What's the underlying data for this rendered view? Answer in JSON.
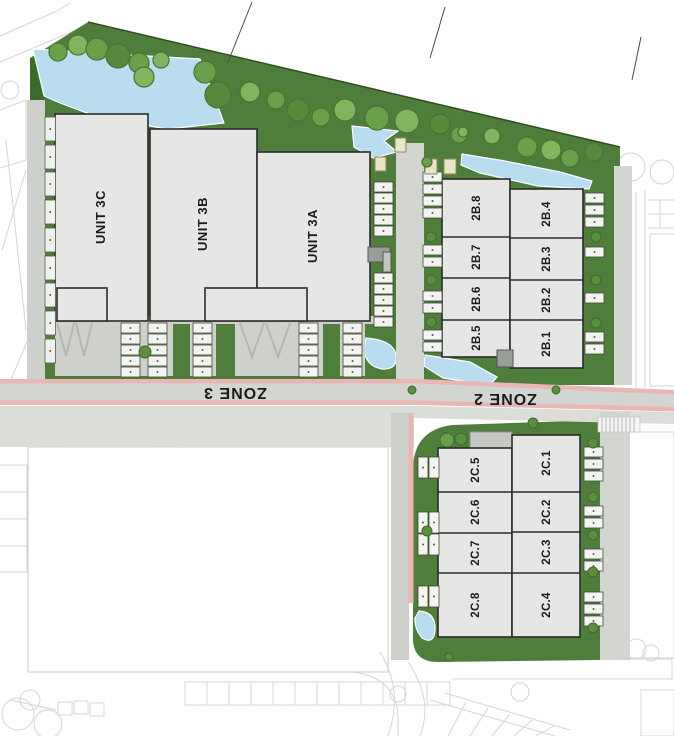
{
  "plan": {
    "zone_labels": {
      "zone3": "ZONE 3",
      "zone2": "ZONE 2"
    },
    "zone3_units": [
      {
        "id": "3C",
        "label": "UNIT 3C"
      },
      {
        "id": "3B",
        "label": "UNIT 3B"
      },
      {
        "id": "3A",
        "label": "UNIT 3A"
      }
    ],
    "zone2b_units": [
      "2B.8",
      "2B.7",
      "2B.6",
      "2B.5",
      "2B.4",
      "2B.3",
      "2B.2",
      "2B.1"
    ],
    "zone2c_units": [
      "2C.5",
      "2C.6",
      "2C.7",
      "2C.8",
      "2C.1",
      "2C.2",
      "2C.3",
      "2C.4"
    ]
  },
  "legend_colors": {
    "landscape_green": "#4f7d3b",
    "dark_green": "#3c6a2c",
    "tree_green": "#6ba04b",
    "water_blue": "#b9dcee",
    "building_grey": "#e6e7e5",
    "road_grey": "#d3d5d1",
    "road_edge_pink": "#e7b6b5",
    "context_line_grey": "#d2d2d2"
  }
}
